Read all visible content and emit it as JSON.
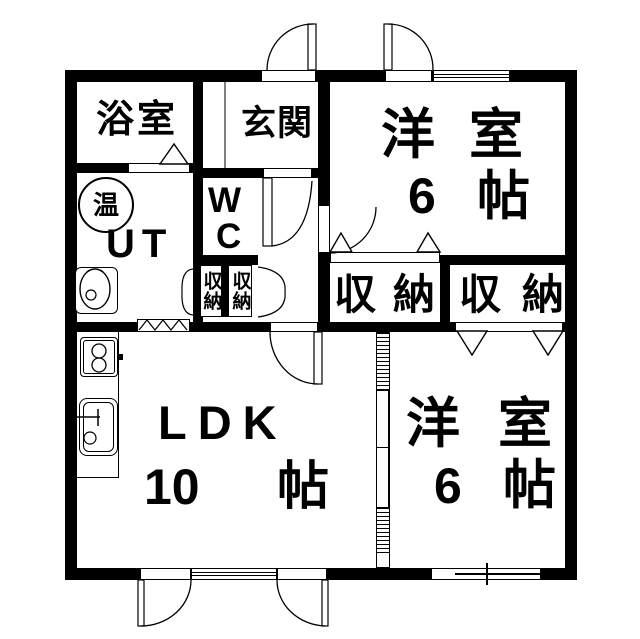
{
  "floorplan": {
    "bathroom": {
      "label": "浴室"
    },
    "entrance": {
      "label": "玄関"
    },
    "toilet": {
      "line1": "W",
      "line2": "C"
    },
    "utility": {
      "label": "UT",
      "water_heater": "温"
    },
    "closet_small_left": {
      "label": "収納"
    },
    "closet_small_right": {
      "label": "収納"
    },
    "closet_room_top": {
      "label": "収納"
    },
    "closet_room_bottom": {
      "label": "収納"
    },
    "room_top": {
      "label": "洋室",
      "size_value": "6",
      "size_unit": "帖"
    },
    "ldk": {
      "label": "LDK",
      "size_value": "10",
      "size_unit": "帖"
    },
    "room_bottom": {
      "label": "洋室",
      "size_value": "6",
      "size_unit": "帖"
    }
  }
}
